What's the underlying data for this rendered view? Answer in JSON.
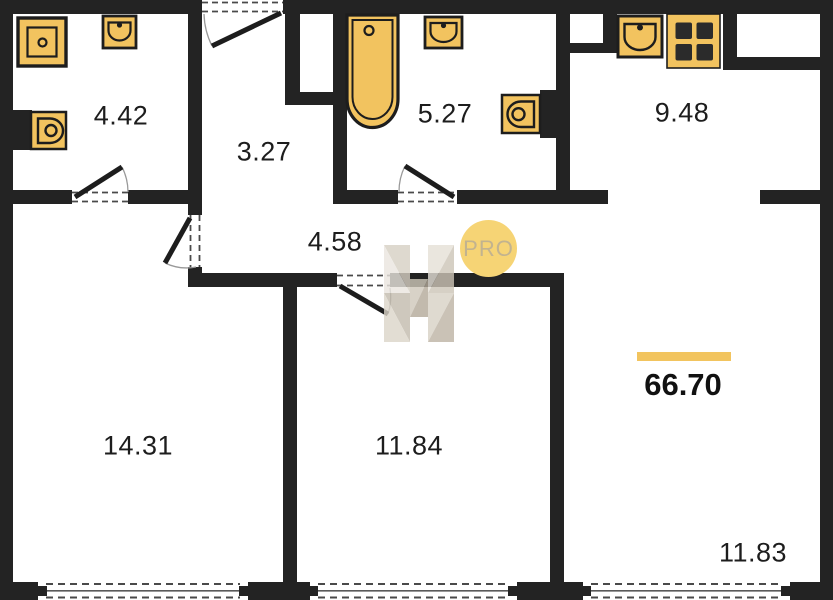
{
  "plan": {
    "total_area": "66.70",
    "rooms": [
      {
        "name": "bathroom-small",
        "area": "4.42"
      },
      {
        "name": "entry-hall",
        "area": "3.27"
      },
      {
        "name": "bathroom-large",
        "area": "5.27"
      },
      {
        "name": "kitchen",
        "area": "9.48"
      },
      {
        "name": "hallway",
        "area": "4.58"
      },
      {
        "name": "room-left",
        "area": "14.31"
      },
      {
        "name": "room-middle",
        "area": "11.84"
      },
      {
        "name": "room-right",
        "area": "11.83"
      }
    ]
  },
  "branding": {
    "badge_text": "PRO"
  },
  "icons": [
    "shower-icon",
    "sink-icon",
    "toilet-icon",
    "bathtub-icon",
    "kitchen-sink-icon",
    "stove-icon",
    "door-icon",
    "window-icon",
    "h-logo-watermark-icon"
  ],
  "colors": {
    "wall": "#232323",
    "fixture_fill": "#F2C35F",
    "fixture_stroke": "#1D1D1D",
    "accent_bar": "#F2C45E",
    "badge_bg": "#F6D475",
    "badge_text": "#C2B38F",
    "label_text": "#1D1D1D"
  }
}
